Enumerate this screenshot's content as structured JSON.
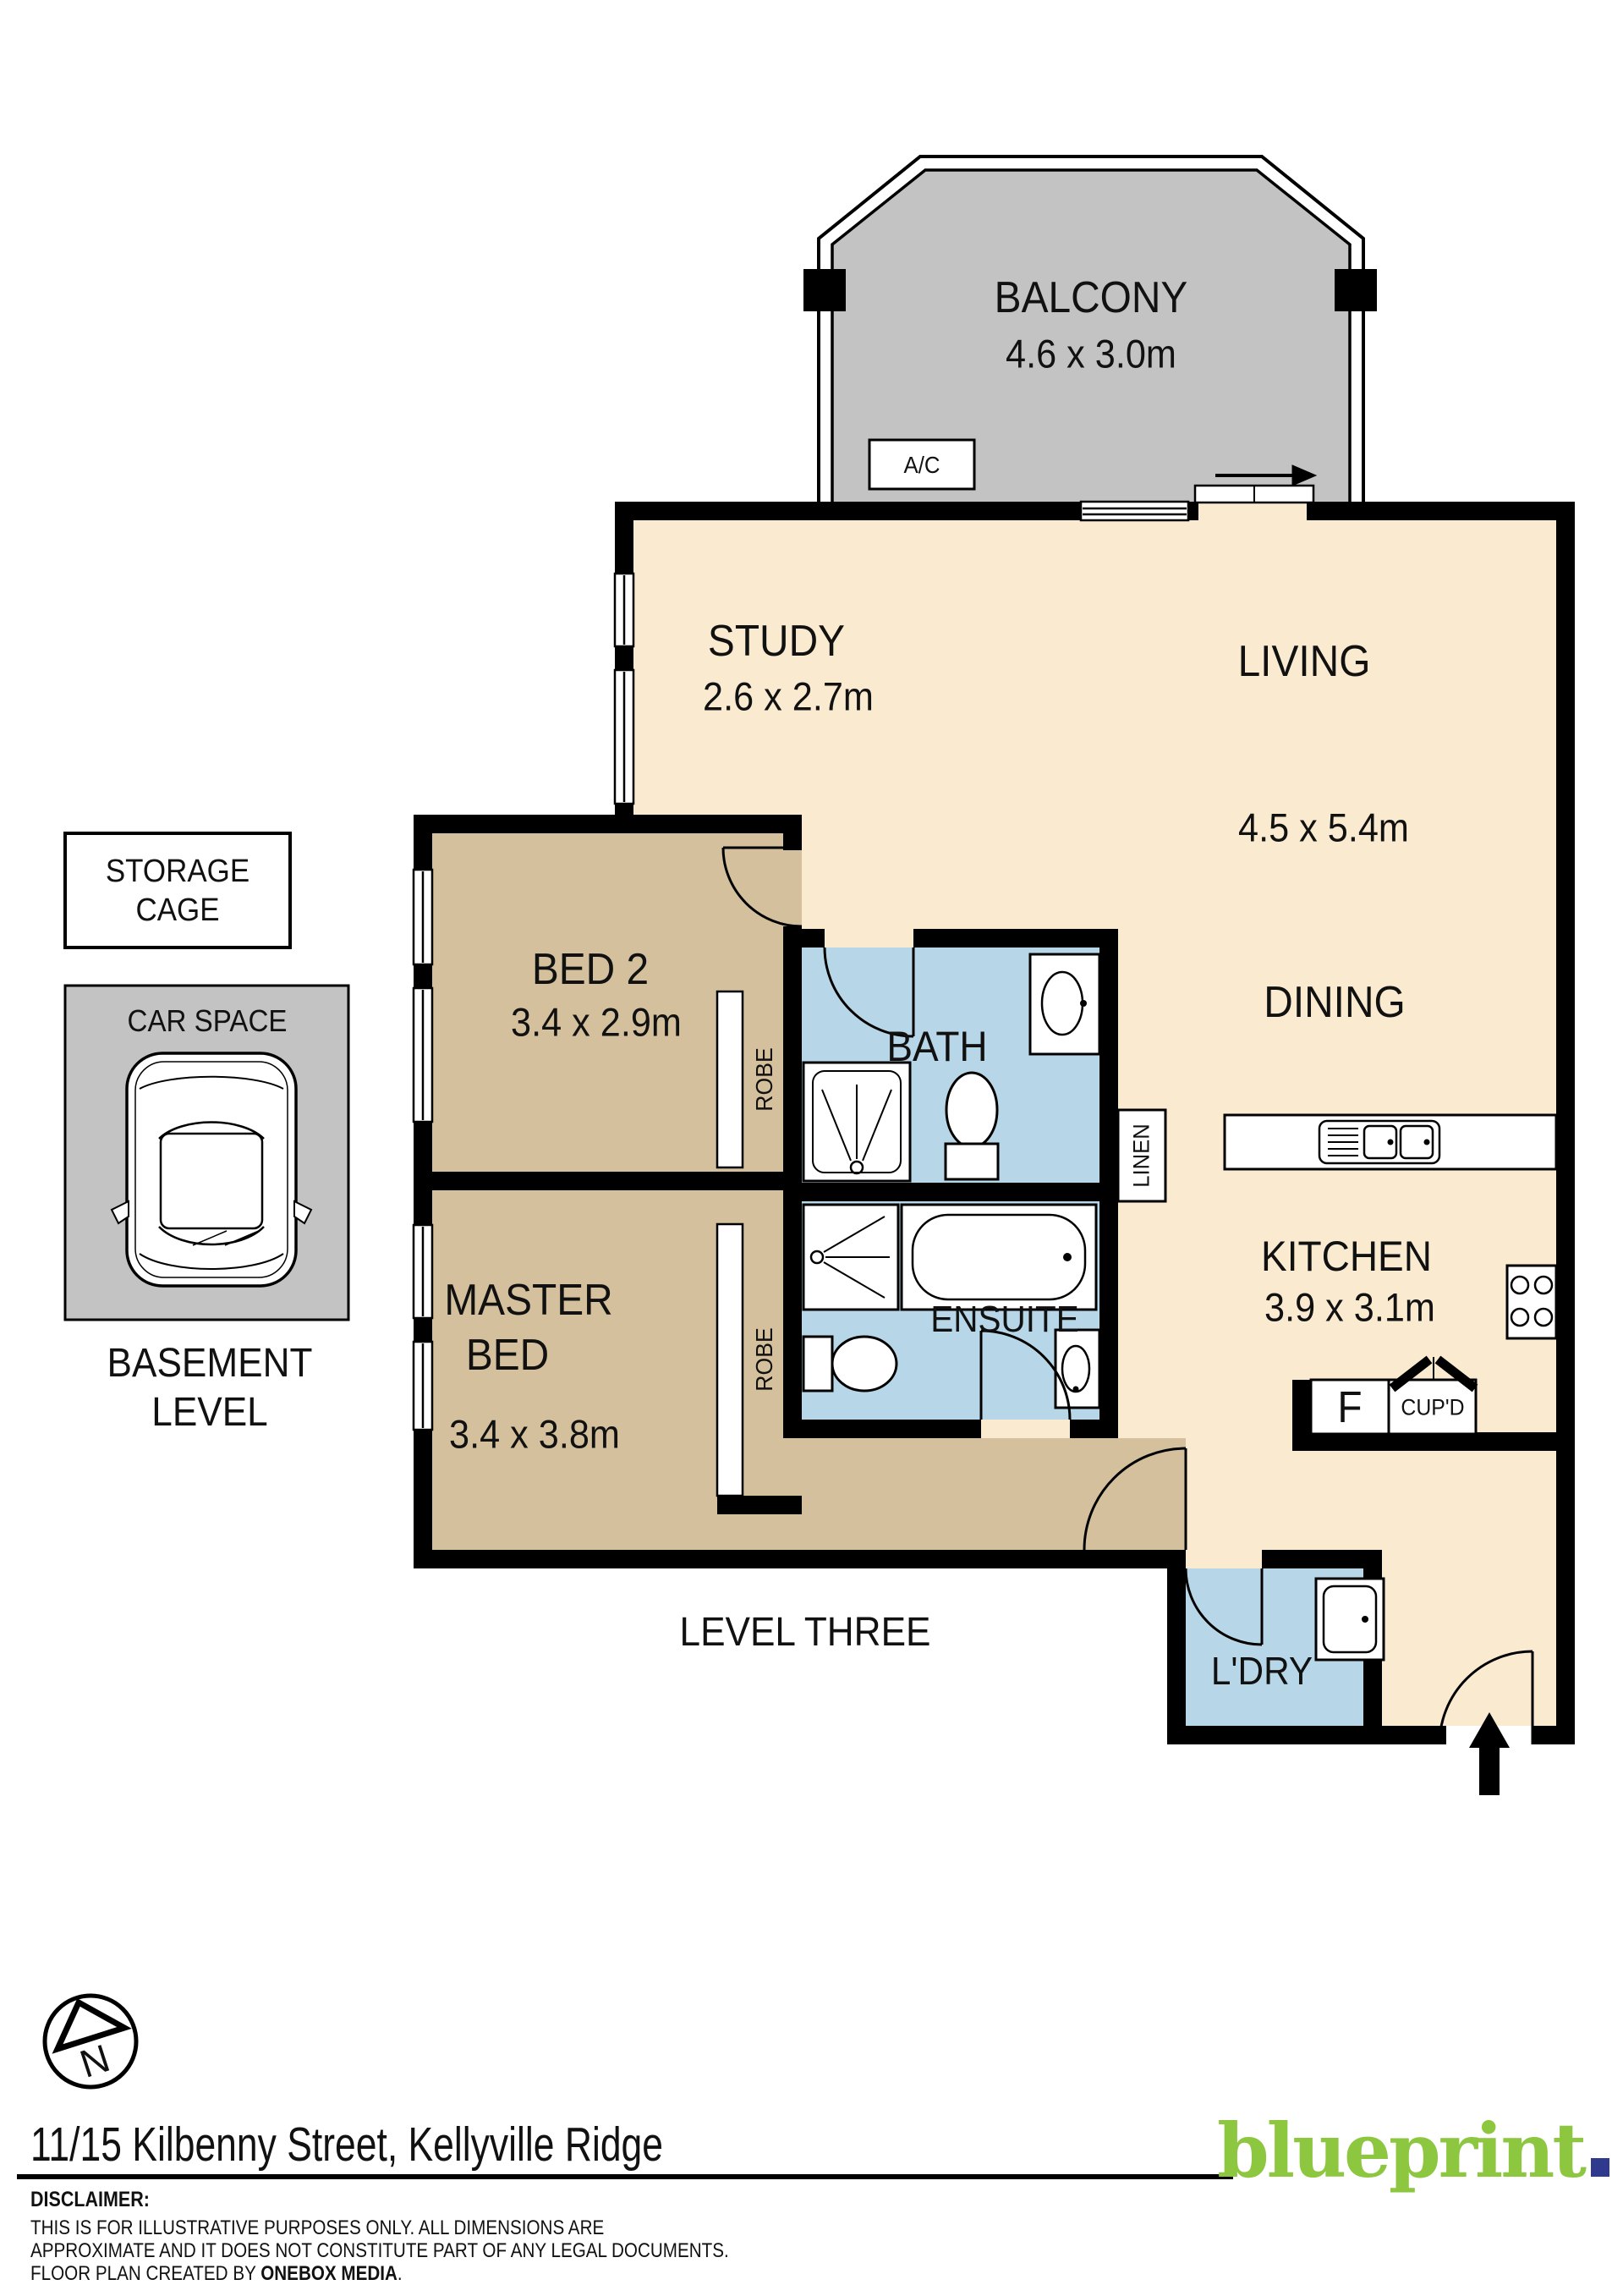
{
  "rooms": {
    "balcony": {
      "name": "BALCONY",
      "dims": "4.6 x 3.0m"
    },
    "study": {
      "name": "STUDY",
      "dims": "2.6 x 2.7m"
    },
    "living": {
      "name": "LIVING",
      "dims": "4.5 x 5.4m"
    },
    "dining": {
      "name": "DINING"
    },
    "bed2": {
      "name": "BED 2",
      "dims": "3.4 x 2.9m"
    },
    "master": {
      "line1": "MASTER",
      "line2": "BED",
      "dims": "3.4 x 3.8m"
    },
    "bath": {
      "name": "BATH"
    },
    "ensuite": {
      "name": "ENSUITE"
    },
    "kitchen": {
      "name": "KITCHEN",
      "dims": "3.9 x 3.1m"
    },
    "laundry": {
      "name": "L'DRY"
    },
    "linen": {
      "name": "LINEN"
    },
    "robe": {
      "name": "ROBE"
    }
  },
  "features": {
    "ac": "A/C",
    "fridge": "F",
    "cupboard": "CUP'D"
  },
  "basement": {
    "storage_line1": "STORAGE",
    "storage_line2": "CAGE",
    "car_space": "CAR SPACE",
    "label_line1": "BASEMENT",
    "label_line2": "LEVEL"
  },
  "plan": {
    "level_label": "LEVEL THREE"
  },
  "compass": {
    "north": "N"
  },
  "footer": {
    "address": "11/15 Kilbenny Street, Kellyville Ridge",
    "logo": "blueprint",
    "disclaimer_title": "DISCLAIMER:",
    "disclaimer_line1": "THIS IS FOR ILLUSTRATIVE PURPOSES ONLY. ALL DIMENSIONS ARE",
    "disclaimer_line2": "APPROXIMATE AND IT DOES NOT CONSTITUTE PART OF ANY LEGAL DOCUMENTS.",
    "disclaimer_line3_prefix": "FLOOR PLAN CREATED BY ",
    "disclaimer_line3_bold": "ONEBOX MEDIA",
    "disclaimer_line3_suffix": "."
  },
  "colors": {
    "floor": "#f9ead0",
    "bedroom": "#d4c09c",
    "wet_area": "#b7d7e8",
    "outdoor": "#c3c3c3",
    "wall": "#000000",
    "logo_green": "#8dc63f",
    "logo_navy": "#2f3a8f"
  }
}
